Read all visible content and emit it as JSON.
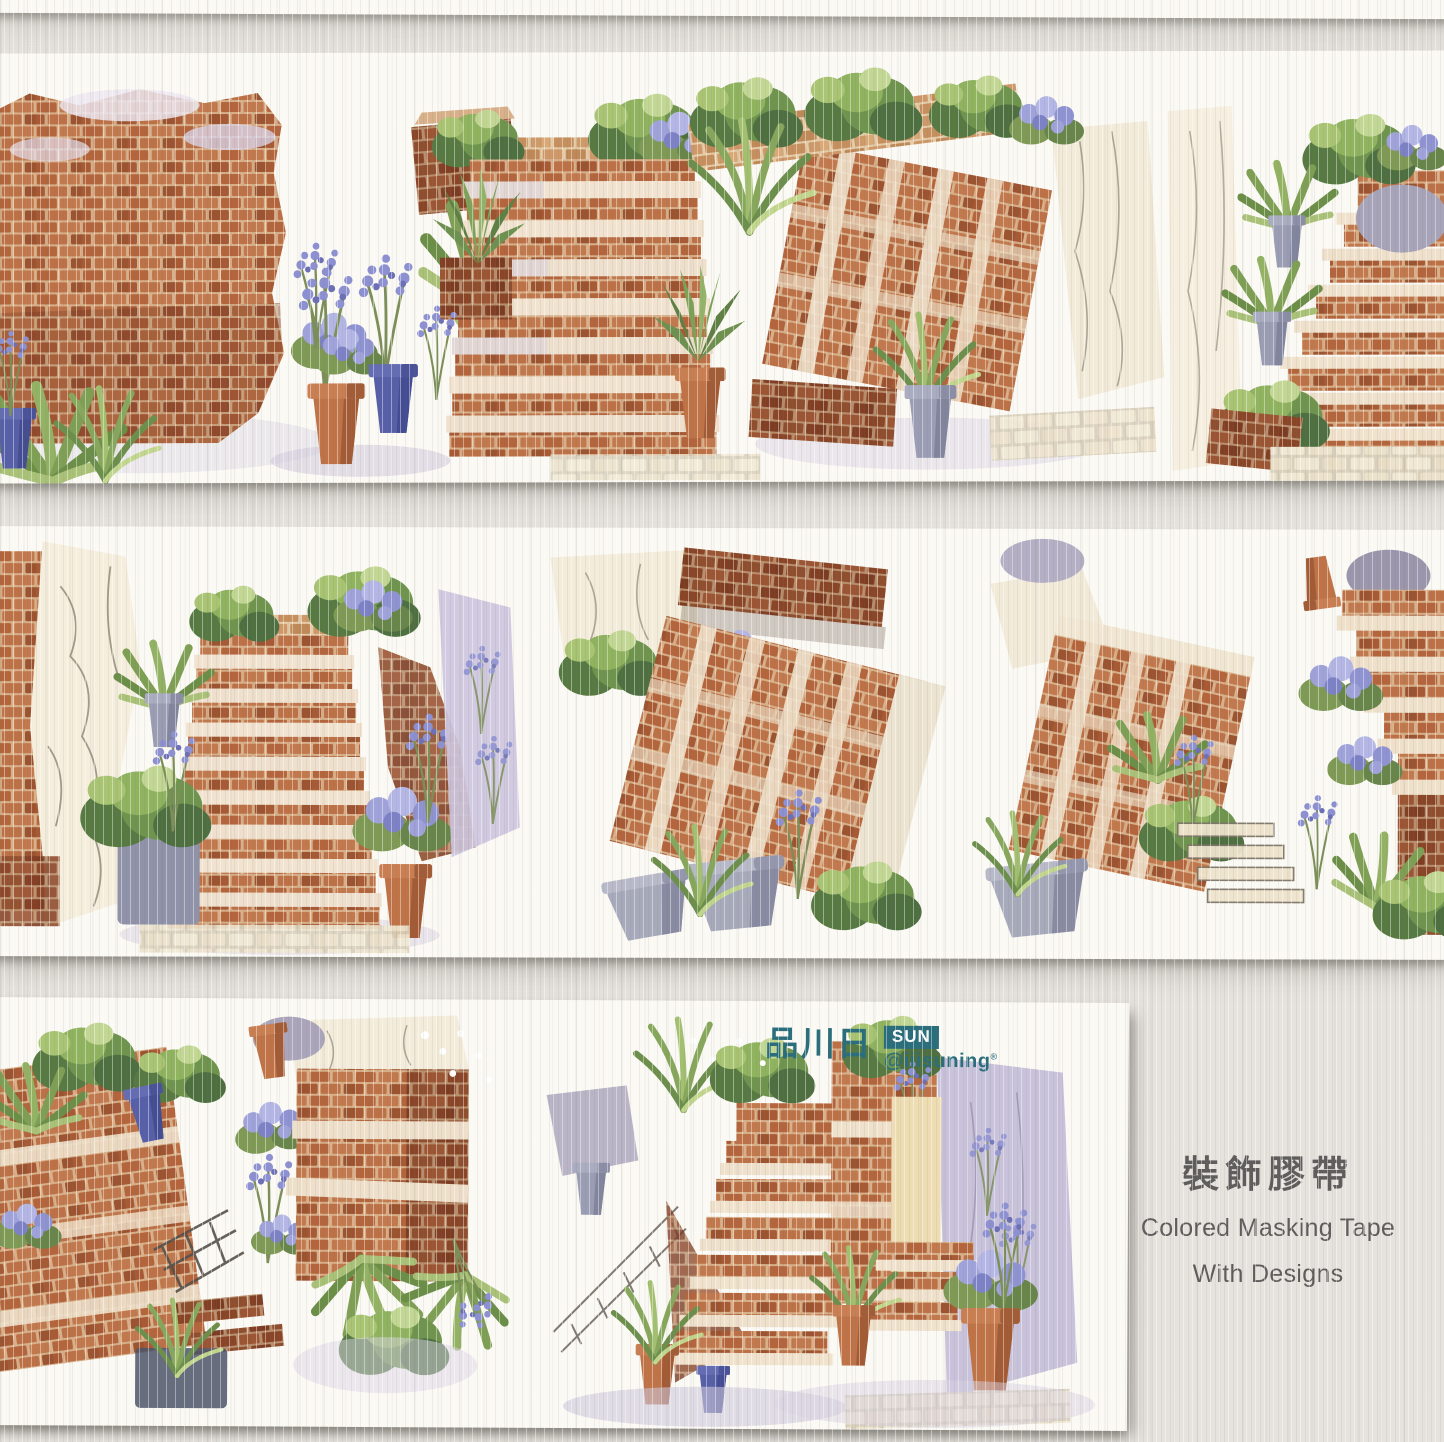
{
  "branding": {
    "brand_cjk": "品川日",
    "brand_en": "SUN",
    "handle": "@iiisuning",
    "handle_mark": "®",
    "brand_color": "#2a6e7c"
  },
  "caption": {
    "title_cjk": "裝飾膠帶",
    "subtitle_line1": "Colored Masking Tape",
    "subtitle_line2": "With Designs",
    "text_color": "#5e5d5b"
  },
  "strips": [
    {
      "id": "tape-strip-1",
      "scenes": [
        "brick-wall-with-ferns",
        "potted-lavender",
        "front-staircase",
        "angled-staircase",
        "right-staircase"
      ]
    },
    {
      "id": "tape-strip-2",
      "scenes": [
        "stone-wall",
        "staircase-with-pots",
        "overhang-staircase",
        "stair-fragment",
        "corner-stairs"
      ]
    },
    {
      "id": "tape-strip-3",
      "scenes": [
        "left-stair-mass",
        "brick-pillar",
        "courtyard-stairs",
        "walled-staircase"
      ]
    }
  ],
  "palette": {
    "background": "#e6e3de",
    "tape": "#fbf9f4",
    "brick": "#b4653c",
    "brick_dark": "#8f4a2b",
    "brick_light": "#c98a5e",
    "mortar": "#d8b08a",
    "tread": "#f1e3cf",
    "stone": "#f2ead7",
    "foliage_dark": "#4e7040",
    "foliage": "#6f944e",
    "foliage_light": "#a9c573",
    "lavender": "#8d91d2",
    "lavender_deep": "#6c70b6",
    "pot_terracotta": "#bf7347",
    "pot_blue": "#575fa8",
    "pot_gray": "#9a9db4",
    "wall_lilac": "#c9c2db"
  }
}
